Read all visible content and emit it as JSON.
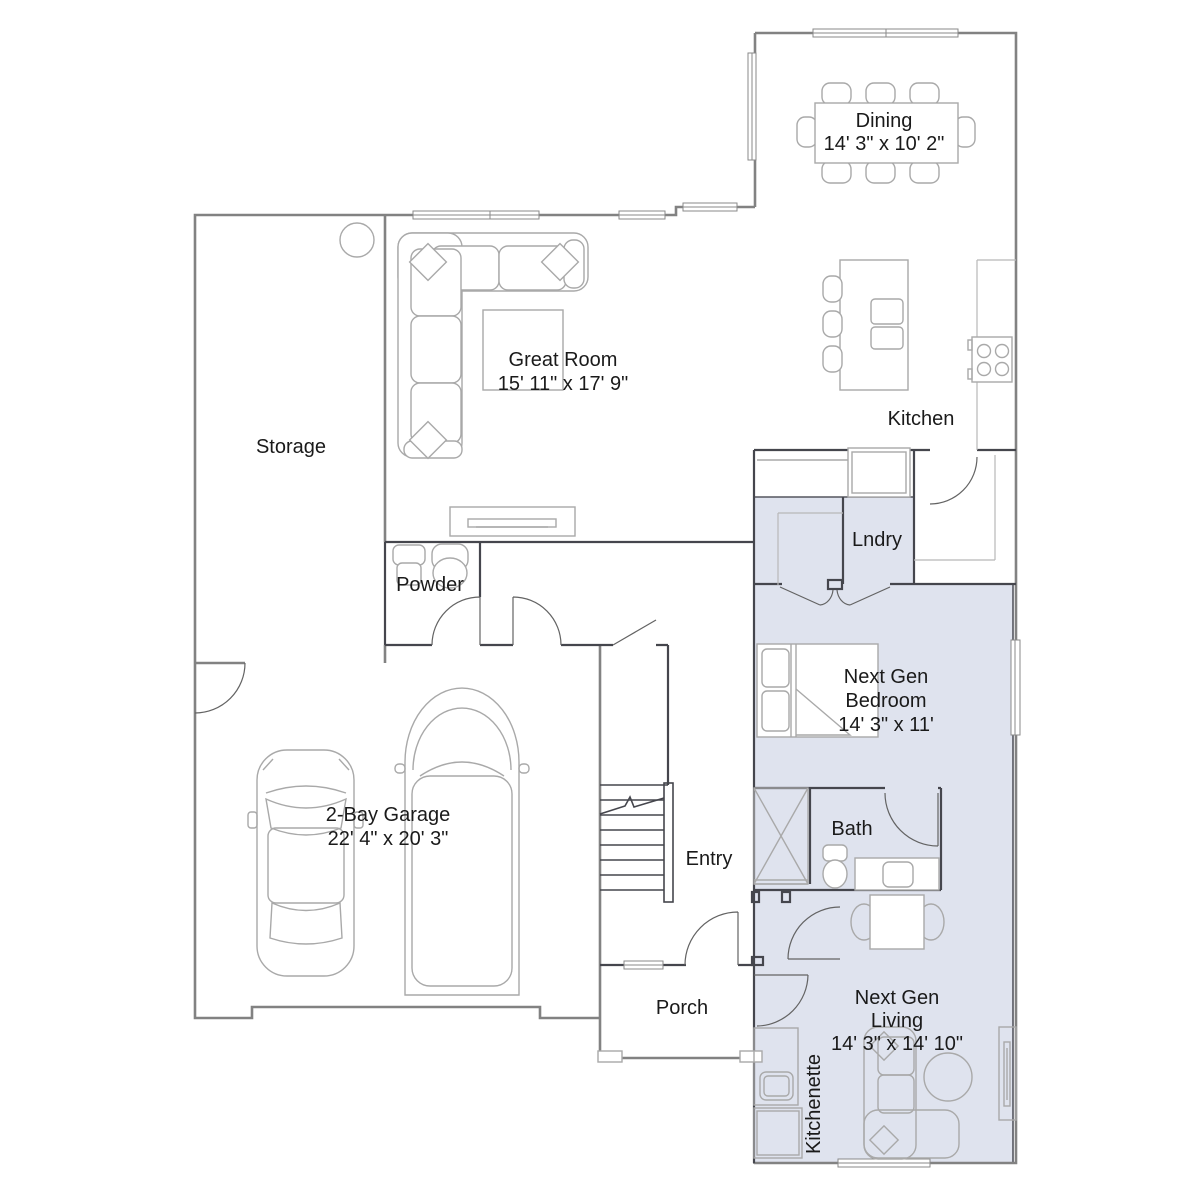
{
  "colors": {
    "ext": "#828282",
    "int": "#45464d",
    "suite": "#dfe3ee",
    "suiteline": "#55565f",
    "furn": "#a9a9a9",
    "door": "#636363",
    "txt": "#1a1a1a"
  },
  "rooms": {
    "dining": {
      "label": "Dining",
      "dims": "14' 3\" x 10' 2\""
    },
    "kitchen": {
      "label": "Kitchen"
    },
    "great_room": {
      "label": "Great Room",
      "dims": "15' 11\" x 17' 9\""
    },
    "storage": {
      "label": "Storage"
    },
    "powder": {
      "label": "Powder"
    },
    "laundry": {
      "label": "Lndry"
    },
    "next_gen_bedroom": {
      "label_line1": "Next Gen",
      "label_line2": "Bedroom",
      "dims": "14' 3\" x 11'"
    },
    "bath": {
      "label": "Bath"
    },
    "garage": {
      "label": "2-Bay Garage",
      "dims": "22' 4\" x 20' 3\""
    },
    "entry": {
      "label": "Entry"
    },
    "porch": {
      "label": "Porch"
    },
    "next_gen_living": {
      "label_line1": "Next Gen",
      "label_line2": "Living",
      "dims": "14' 3\" x 14' 10\""
    },
    "kitchenette": {
      "label": "Kitchenette"
    }
  }
}
